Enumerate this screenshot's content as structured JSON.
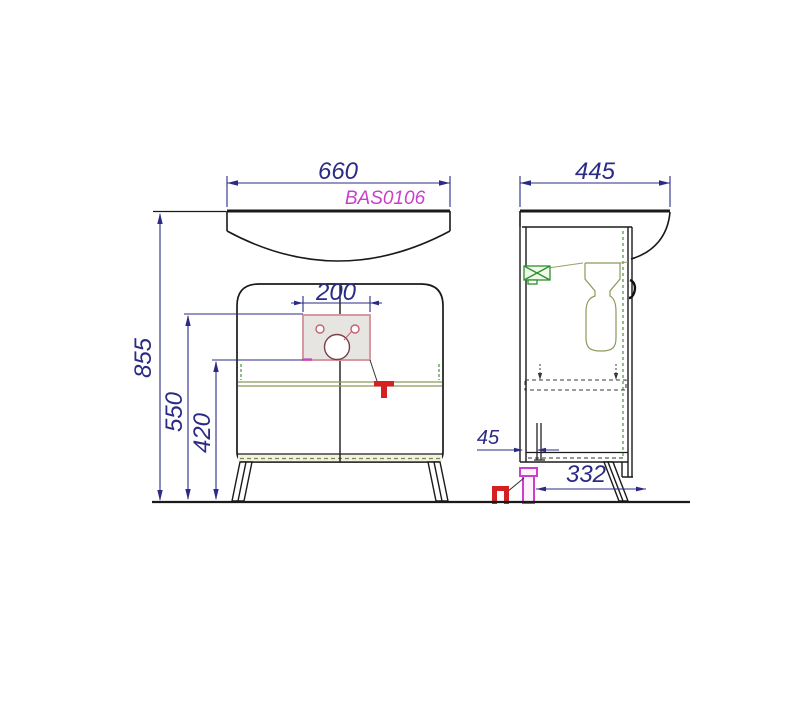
{
  "drawing": {
    "product_code": "BAS0106",
    "dimensions": {
      "overall_width": "660",
      "overall_depth": "445",
      "overall_height": "855",
      "mounting_plate_width": "200",
      "plate_top_from_floor": "550",
      "plate_bottom_from_floor": "420",
      "back_wall_offset": "45",
      "foot_to_leg_distance": "332"
    },
    "colors": {
      "dimension_navy": "#2b2b85",
      "product_code_magenta": "#c83fc8",
      "annotation_red": "#d42020",
      "foot_magenta": "#cc3fcc",
      "fitting_green": "#2f8f2f",
      "hidden_edge_green": "#4a8f3f",
      "shelf_olive": "#8a9a5a",
      "plate_border_pink": "#d898a0",
      "outline_black": "#1a1a1a"
    }
  }
}
